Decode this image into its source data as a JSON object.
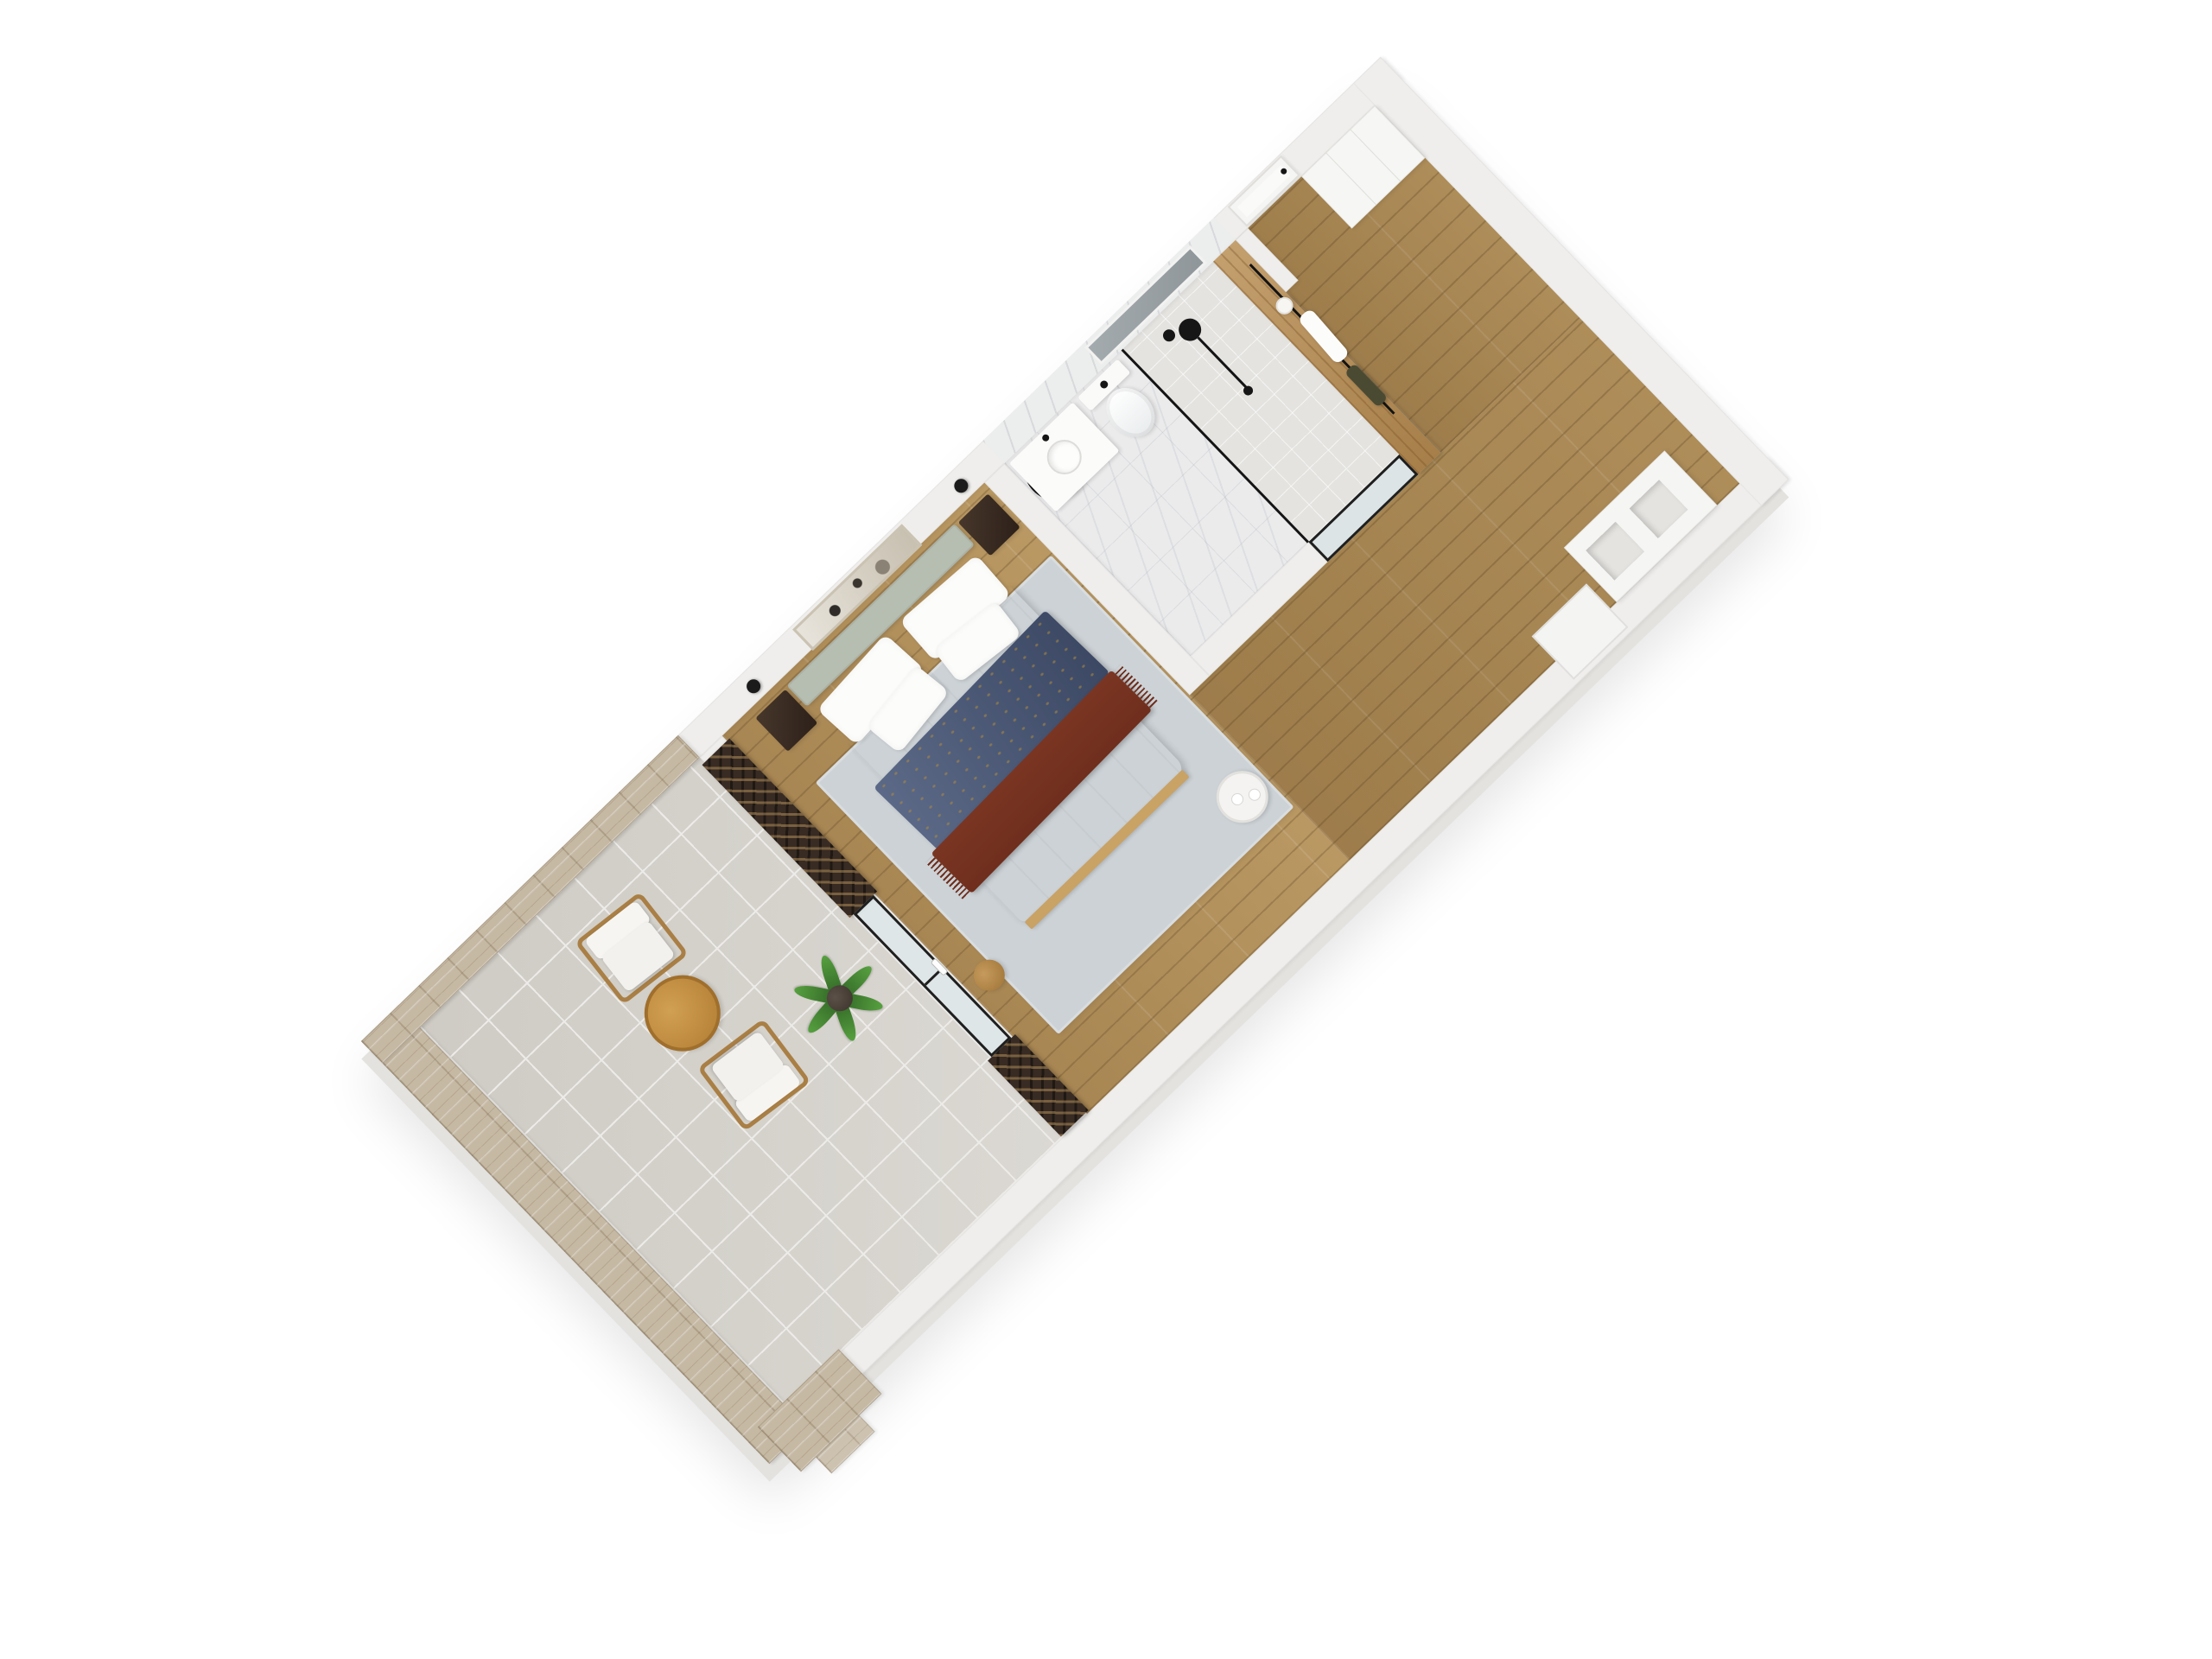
{
  "scene": {
    "type": "3d-floor-plan-render",
    "view": "axonometric top-down, unit rotated ~44 degrees",
    "background": "#ffffff",
    "unit": "studio suite with terrace, bedroom, bathroom and entry hall"
  },
  "palette": {
    "wall": "#efeeec",
    "wallOuter": "#eae9e7",
    "stone": "#c6b9a3",
    "tile": "#d6d3cd",
    "tileLine": "#edebe8",
    "wood": "#b5945f",
    "marble": "#ebebec",
    "rug": "#ccd2d6",
    "headboard": "#b6bdb1",
    "navy": "#49587a",
    "maroon": "#6f2e1d",
    "lattice": "#382b23",
    "oak": "#b98f55",
    "chairWood": "#a97f45"
  },
  "rooms": [
    {
      "id": "terrace",
      "label": "Terrace",
      "floor": "grey ceramic tile",
      "walls": "travertine stone with parapet",
      "items": [
        "lounge chair",
        "lounge chair",
        "round wooden coffee table",
        "potted plant",
        "dark lattice privacy screens",
        "stone pillar with steps"
      ]
    },
    {
      "id": "bedroom",
      "label": "Bedroom",
      "floor": "oak plank",
      "items": [
        "double bed",
        "sage upholstered headboard",
        "white pillows",
        "navy throw with gold pattern",
        "maroon fringed runner",
        "walnut nightstand left",
        "walnut nightstand right",
        "black wall sconce left",
        "black wall sconce right",
        "abstract wall artwork",
        "blue-grey area rug",
        "round white side table with tray",
        "round wooden stool",
        "black framed glass doors to terrace"
      ]
    },
    {
      "id": "bathroom",
      "label": "Bathroom",
      "floor": "marble tile",
      "walls": "white marble slab",
      "items": [
        "round black-framed mirror",
        "white vanity with round basin",
        "black faucet",
        "wall-hung toilet",
        "walk-in shower with black framed glass",
        "black rain shower column",
        "skylight window slot"
      ]
    },
    {
      "id": "entry",
      "label": "Entry hall",
      "floor": "oak plank",
      "items": [
        "white entrance door",
        "white built-in wardrobe",
        "open cubby shoe shelf",
        "oak coat panel with black rail",
        "white towel",
        "hanging garment",
        "white cap",
        "wall niche"
      ]
    }
  ]
}
